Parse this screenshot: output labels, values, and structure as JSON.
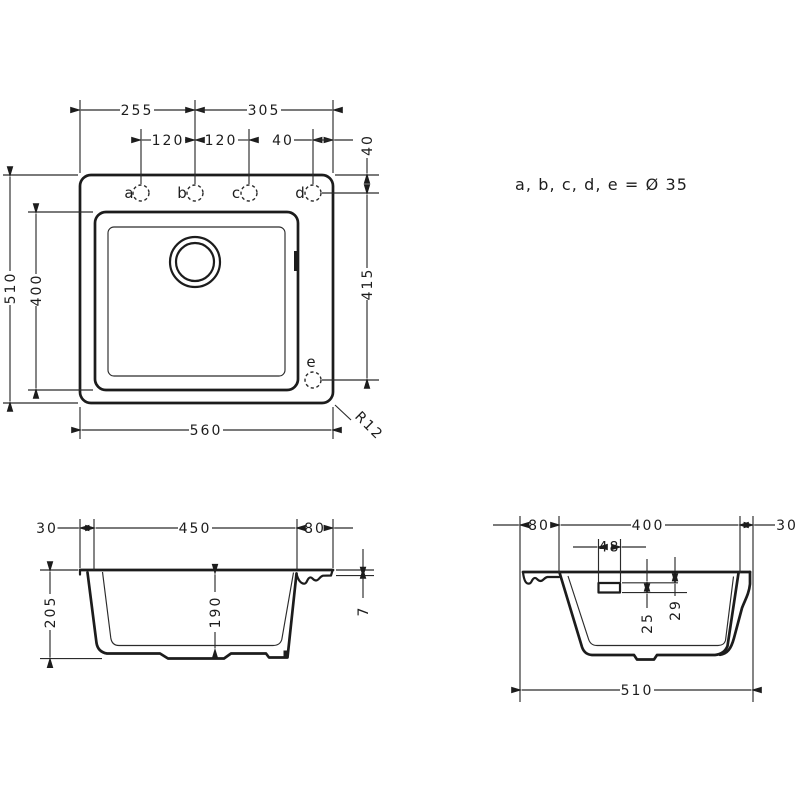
{
  "drawing": {
    "note": "a, b, c, d, e = Ø 35",
    "top_view": {
      "holes": {
        "a": "a",
        "b": "b",
        "c": "c",
        "d": "d",
        "e": "e"
      },
      "dims": {
        "left_to_b": "255",
        "b_to_right": "305",
        "a_to_b": "120",
        "b_to_c": "120",
        "d_to_edge": "40",
        "holes_from_top": "40",
        "overall_depth": "510",
        "bowl_depth": "400",
        "d_to_e": "415",
        "overall_width": "560",
        "corner_radius": "R12"
      }
    },
    "front_section": {
      "dims": {
        "left_rim": "30",
        "bowl_width": "450",
        "right_deck": "80",
        "overall_height": "205",
        "bowl_height": "190",
        "rim_thickness": "7"
      }
    },
    "side_section": {
      "dims": {
        "deck": "80",
        "bowl_width": "400",
        "front_rim": "30",
        "overflow_width": "48",
        "overflow_height": "25",
        "overflow_top_offset": "29",
        "overall_width": "510"
      }
    }
  }
}
